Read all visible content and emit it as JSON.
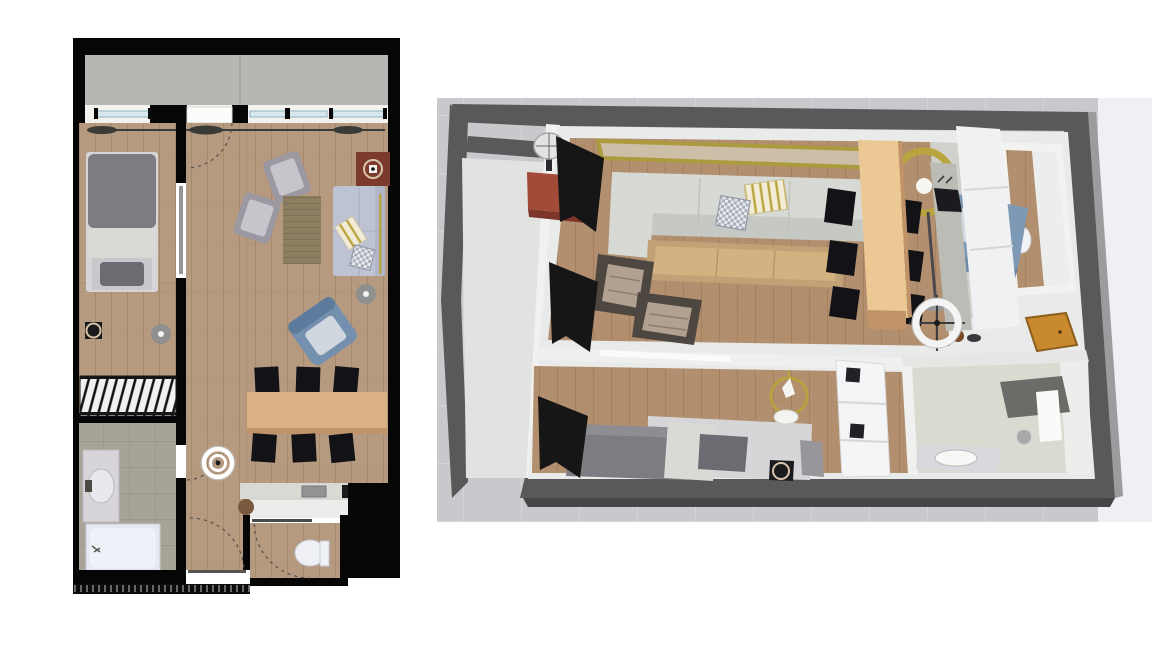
{
  "scene": {
    "panels": {
      "plan_2d": {
        "type": "2d-top-down-floor-plan",
        "objects": [
          "balcony",
          "balcony-windows",
          "curtain-rod",
          "bedroom-bed",
          "radiator",
          "wall-stove",
          "ceiling-light",
          "bathroom-vanity",
          "bathtub",
          "armchair",
          "armchair",
          "area-rug",
          "sofa",
          "throw-pillows",
          "floor-lamp",
          "pellet-stove",
          "blue-armchair",
          "dining-table",
          "dining-chairs",
          "kitchen-counter",
          "cooktop",
          "kitchen-sink",
          "stool",
          "toilet",
          "door-swing-arcs",
          "hall-ceiling-light",
          "entry-recess",
          "tick-fringe"
        ]
      },
      "view_3d": {
        "type": "3d-aerial-overview",
        "objects": [
          "terrain",
          "outer-walls",
          "balcony",
          "black-curtains",
          "gold-mirror",
          "sofa",
          "striped-pillow",
          "checkered-pillow",
          "red-side-table",
          "table-lamp",
          "gold-floor-lamp",
          "blue-armchair",
          "coffee-table",
          "armchair",
          "armchair",
          "dining-table",
          "dining-chairs",
          "kitchen-cabinets",
          "kitchen-counter",
          "cooktop",
          "pots",
          "ceiling-ring-light",
          "gold-chandelier",
          "wardrobe",
          "bed",
          "nightstand",
          "pellet-stove",
          "entry-door",
          "bathroom-vanity",
          "round-mirror",
          "shower",
          "toilet-room",
          "toilet"
        ]
      }
    }
  },
  "palette": {
    "page_bg": "#ffffff",
    "wall2d": "#060606",
    "concrete": "#b6b6b3",
    "concrete_line": "#a2a29f",
    "wood2d": "#b59a7f",
    "wood2d_line": "#a3866a",
    "bathtile": "#a7a396",
    "bathtile_line": "#98947f",
    "sill": "#f3f2ef",
    "glass": "#d6e7ed",
    "glass_line": "#8fb6c4",
    "door_white": "#fcfcfa",
    "door_leaf": "#969696",
    "arc": "#4f4f4f",
    "rod": "#3a3a36",
    "duvet": "#7e7c83",
    "blanket": "#dbd9d6",
    "bedframe": "#d6d6d8",
    "pillow_dark": "#6d6b72",
    "radiator_bg": "#f1f1ef",
    "stove_red": "#7c3a2e",
    "stove_ring": "#d9c4a9",
    "rug": "#8c7e61",
    "rug_line": "#7a6c51",
    "chair_gray": "#9c98a1",
    "chair_gray_light": "#c7c4cc",
    "sofa2d": "#bdc3d3",
    "sofa2d_dark": "#a8afc3",
    "gold": "#b9a53f",
    "blue_chair": "#7490ae",
    "blue_dark": "#5d7b9d",
    "blue_light": "#d0d7de",
    "table_tan": "#dab286",
    "table_dark": "#c09468",
    "chair_black": "#121217",
    "counter_top": "#dadad5",
    "counter_white": "#ececea",
    "appl_black": "#1b1b1f",
    "appl_gray": "#939393",
    "white": "#ffffff",
    "toilet": "#eef0f6",
    "tub": "#e3e8f3",
    "marble": "#d7d5d9",
    "dot_gray": "#8f8f8f",
    "stool_brown": "#7a5a3e",
    "terrain": "#c8c8cd",
    "terrain_line": "#d5d5d9",
    "terrain_light": "#eef0f6",
    "wall3d": "#595959",
    "wall3d_light": "#9c9c9e",
    "wall3d_shadow": "#464646",
    "innerwall": "#e9ebeb",
    "balcony_floor": "#e2e3e1",
    "windowband": "#f1f2f0",
    "wood3d": "#b28f6e",
    "wood3d_line": "#a17c59",
    "kitchen_floor": "#d0d1cc",
    "bath3d": "#d9dbd1",
    "partition": "#efefed",
    "lintel": "#fbfbfb",
    "sofa3d": "#d7d9d5",
    "sofa3d_dark": "#c5c8c3",
    "mirror_gold": "#ab9a3e",
    "mirror_glass": "#cdbfa7",
    "redtable": "#a34a38",
    "redtable_dark": "#7e352a",
    "lampshade": "#e3e3e1",
    "stand": "#4a4a4e",
    "blue3d": "#7e99b5",
    "blue3d_dark": "#6b88a6",
    "blue3d_light": "#d3d8df",
    "coffee": "#c2a176",
    "coffee_top": "#d4b181",
    "chairframe": "#4e4741",
    "cushion": "#b2a190",
    "cushion_line": "#8d7c6b",
    "cab_white": "#f0f1f2",
    "cab_line": "#d5d6d8",
    "counter3d": "#bcbcb6",
    "shower": "#6b6b68",
    "vanity": "#d9d8dc",
    "wardrobe": "#f4f5f6",
    "orange": "#c9892f",
    "nightstand": "#97979b",
    "curtain": "#161616",
    "toilet3d": "#f2f3f6",
    "ring_white": "#f4f4f4",
    "chand_gold": "#b5a23e"
  }
}
